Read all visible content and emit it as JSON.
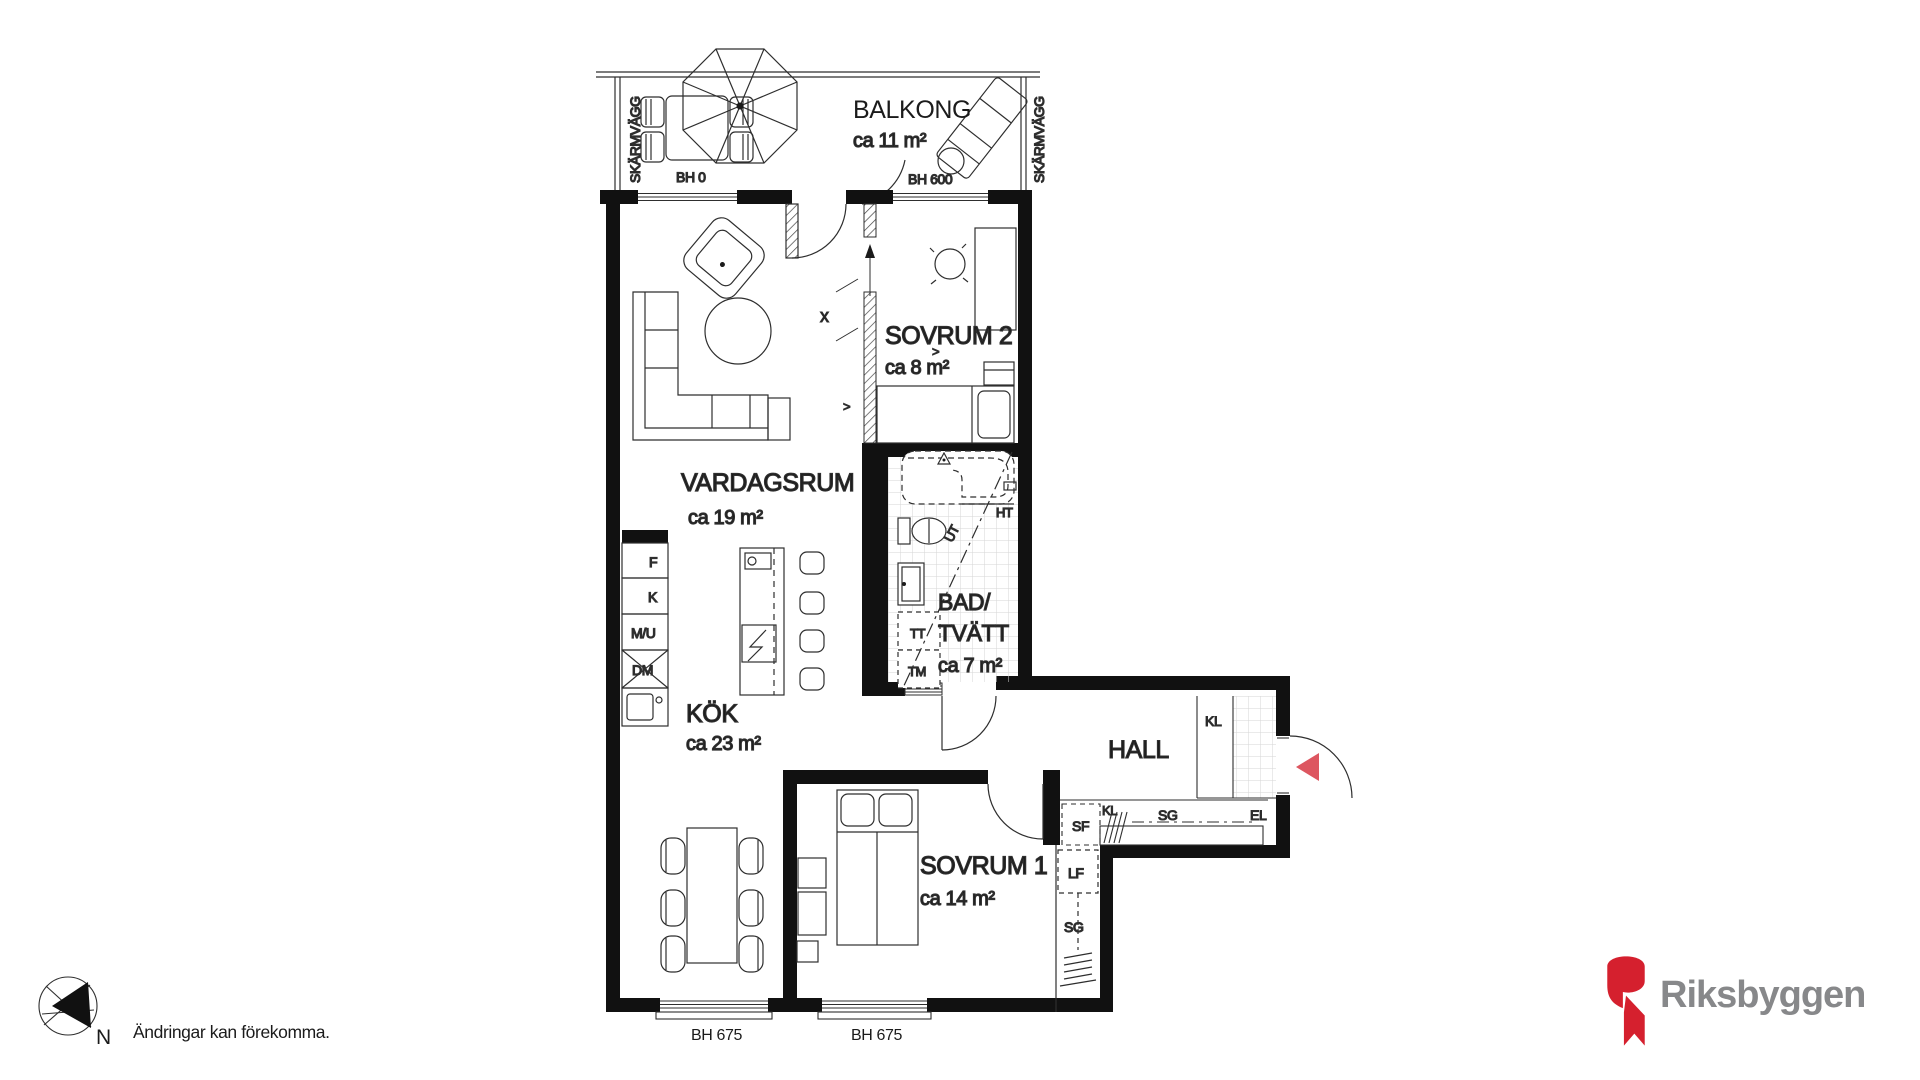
{
  "plan": {
    "balcony": {
      "name": "BALKONG",
      "area": "ca 11 m²",
      "screen_left": "SKÄRMVÄGG",
      "screen_right": "SKÄRMVÄGG",
      "sill_left": "BH 0",
      "sill_right": "BH 600"
    },
    "living_room": {
      "name": "VARDAGSRUM",
      "area": "ca 19 m²"
    },
    "bedroom2": {
      "name": "SOVRUM 2",
      "area": "ca 8 m²",
      "slide_marker": "x",
      "arrow_a": ">",
      "arrow_b": ">"
    },
    "bathroom": {
      "name_line1": "BAD/",
      "name_line2": "TVÄTT",
      "area": "ca 7 m²",
      "dryer": "TT",
      "washer": "TM",
      "towel_rail": "HT",
      "vent": "UT"
    },
    "kitchen": {
      "name": "KÖK",
      "area": "ca 23 m²",
      "appliance_f": "F",
      "appliance_k": "K",
      "appliance_mu": "M/U",
      "appliance_dm": "DM"
    },
    "hall": {
      "name": "HALL",
      "closet_top": "KL",
      "closet_row_kl": "KL",
      "closet_row_sg": "SG",
      "electric": "EL",
      "shoe_cabinet": "SF"
    },
    "bedroom1": {
      "name": "SOVRUM 1",
      "area": "ca 14 m²",
      "linen": "LF",
      "wardrobe": "SG"
    },
    "sill_bottom_left": "BH 675",
    "sill_bottom_right": "BH 675",
    "compass_n": "N"
  },
  "footer": {
    "disclaimer": "Ändringar kan förekomma.",
    "brand": "Riksbyggen"
  },
  "colors": {
    "wall": "#111111",
    "line": "#2e2e2e",
    "tile": "#d6d6d6",
    "entry_arrow": "#dd5660",
    "brand_red": "#d5202e",
    "brand_gray": "#87888a"
  }
}
